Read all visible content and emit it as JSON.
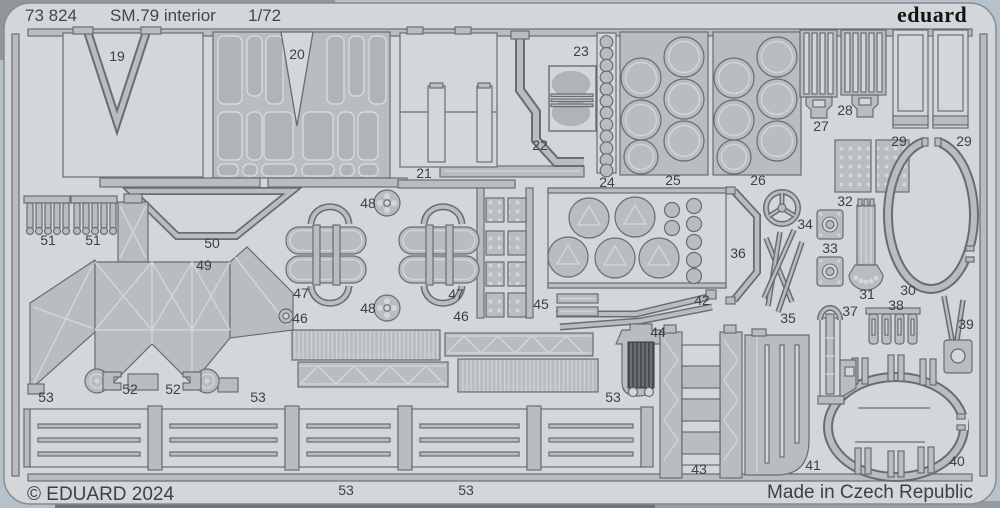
{
  "header": {
    "sheet_number": "73 824",
    "title": "SM.79 interior",
    "scale": "1/72",
    "brand": "eduard"
  },
  "footer": {
    "copyright": "© EDUARD 2024",
    "made_in": "Made in Czech Republic"
  },
  "colors": {
    "backdrop": "#b7c1c9",
    "sheet": "#d4d7d9",
    "part": "#b9bdc0",
    "outline": "#696d71",
    "dark_detail": "#4b4f53",
    "text": "#3d4145",
    "brand_text": "#141414"
  },
  "part_labels": [
    {
      "num": "19",
      "x": 117,
      "y": 61
    },
    {
      "num": "20",
      "x": 297,
      "y": 59
    },
    {
      "num": "21",
      "x": 424,
      "y": 178
    },
    {
      "num": "22",
      "x": 540,
      "y": 150
    },
    {
      "num": "23",
      "x": 581,
      "y": 56
    },
    {
      "num": "24",
      "x": 607,
      "y": 187
    },
    {
      "num": "25",
      "x": 673,
      "y": 185
    },
    {
      "num": "26",
      "x": 758,
      "y": 185
    },
    {
      "num": "27",
      "x": 821,
      "y": 131
    },
    {
      "num": "28",
      "x": 845,
      "y": 115
    },
    {
      "num": "29",
      "x": 899,
      "y": 146
    },
    {
      "num": "29",
      "x": 964,
      "y": 146
    },
    {
      "num": "30",
      "x": 908,
      "y": 295
    },
    {
      "num": "31",
      "x": 867,
      "y": 299
    },
    {
      "num": "32",
      "x": 845,
      "y": 206
    },
    {
      "num": "33",
      "x": 830,
      "y": 253
    },
    {
      "num": "34",
      "x": 805,
      "y": 229
    },
    {
      "num": "35",
      "x": 788,
      "y": 323
    },
    {
      "num": "36",
      "x": 738,
      "y": 258
    },
    {
      "num": "37",
      "x": 850,
      "y": 316
    },
    {
      "num": "38",
      "x": 896,
      "y": 310
    },
    {
      "num": "39",
      "x": 966,
      "y": 329
    },
    {
      "num": "40",
      "x": 957,
      "y": 466
    },
    {
      "num": "41",
      "x": 813,
      "y": 470
    },
    {
      "num": "42",
      "x": 702,
      "y": 305
    },
    {
      "num": "43",
      "x": 699,
      "y": 474
    },
    {
      "num": "44",
      "x": 658,
      "y": 337
    },
    {
      "num": "45",
      "x": 541,
      "y": 309
    },
    {
      "num": "46",
      "x": 300,
      "y": 323
    },
    {
      "num": "46",
      "x": 461,
      "y": 321
    },
    {
      "num": "47",
      "x": 301,
      "y": 298
    },
    {
      "num": "47",
      "x": 456,
      "y": 299
    },
    {
      "num": "48",
      "x": 368,
      "y": 208
    },
    {
      "num": "48",
      "x": 368,
      "y": 313
    },
    {
      "num": "49",
      "x": 204,
      "y": 270
    },
    {
      "num": "50",
      "x": 212,
      "y": 248
    },
    {
      "num": "51",
      "x": 48,
      "y": 245
    },
    {
      "num": "51",
      "x": 93,
      "y": 245
    },
    {
      "num": "52",
      "x": 130,
      "y": 394
    },
    {
      "num": "52",
      "x": 173,
      "y": 394
    },
    {
      "num": "53",
      "x": 46,
      "y": 402
    },
    {
      "num": "53",
      "x": 258,
      "y": 402
    },
    {
      "num": "53",
      "x": 613,
      "y": 402
    },
    {
      "num": "53",
      "x": 346,
      "y": 495
    },
    {
      "num": "53",
      "x": 466,
      "y": 495
    }
  ]
}
